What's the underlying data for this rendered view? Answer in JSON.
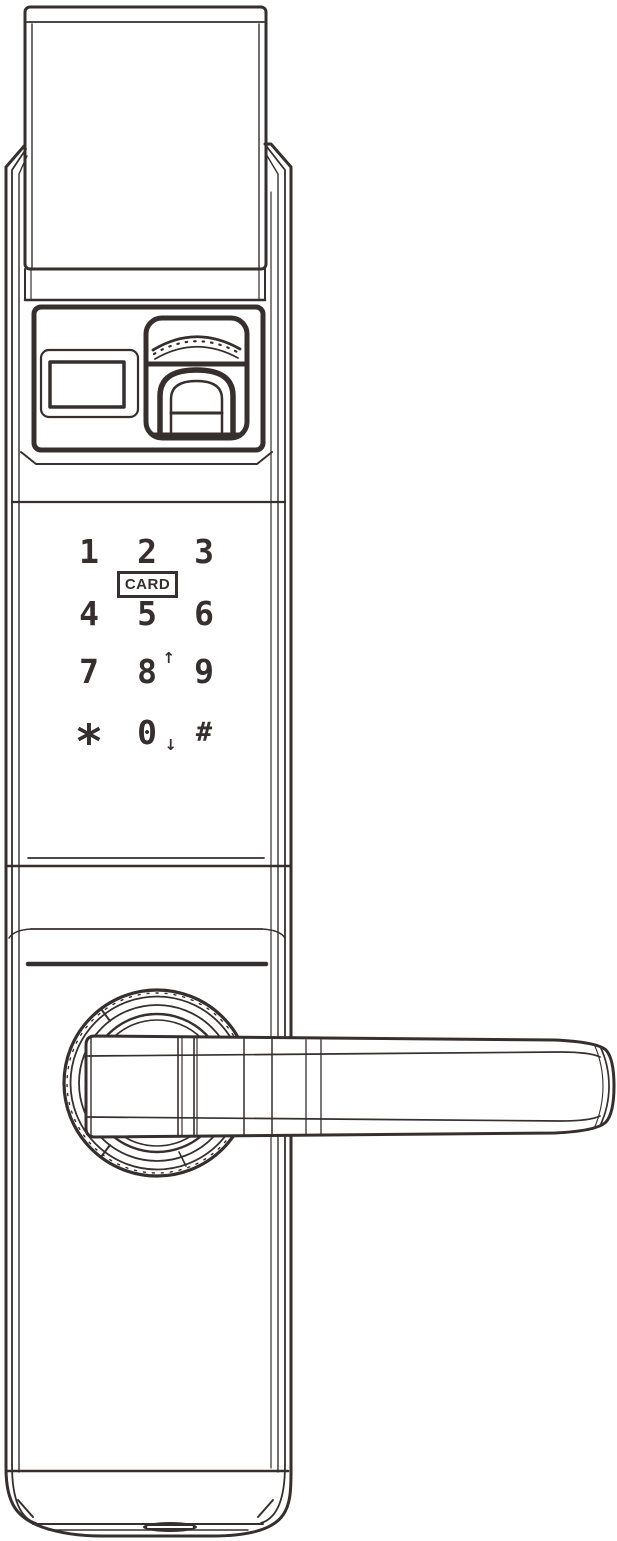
{
  "colors": {
    "line": "#372e2e",
    "background": "#ffffff"
  },
  "keypad": {
    "card_label": "CARD",
    "keys": [
      {
        "id": "key-1",
        "label": "1"
      },
      {
        "id": "key-2",
        "label": "2"
      },
      {
        "id": "key-3",
        "label": "3"
      },
      {
        "id": "key-4",
        "label": "4"
      },
      {
        "id": "key-5",
        "label": "5"
      },
      {
        "id": "key-6",
        "label": "6"
      },
      {
        "id": "key-7",
        "label": "7"
      },
      {
        "id": "key-8",
        "label": "8",
        "arrow": "↑"
      },
      {
        "id": "key-9",
        "label": "9"
      },
      {
        "id": "key-star",
        "label": "*"
      },
      {
        "id": "key-0",
        "label": "0",
        "arrow": "↓"
      },
      {
        "id": "key-hash",
        "label": "#"
      }
    ]
  }
}
